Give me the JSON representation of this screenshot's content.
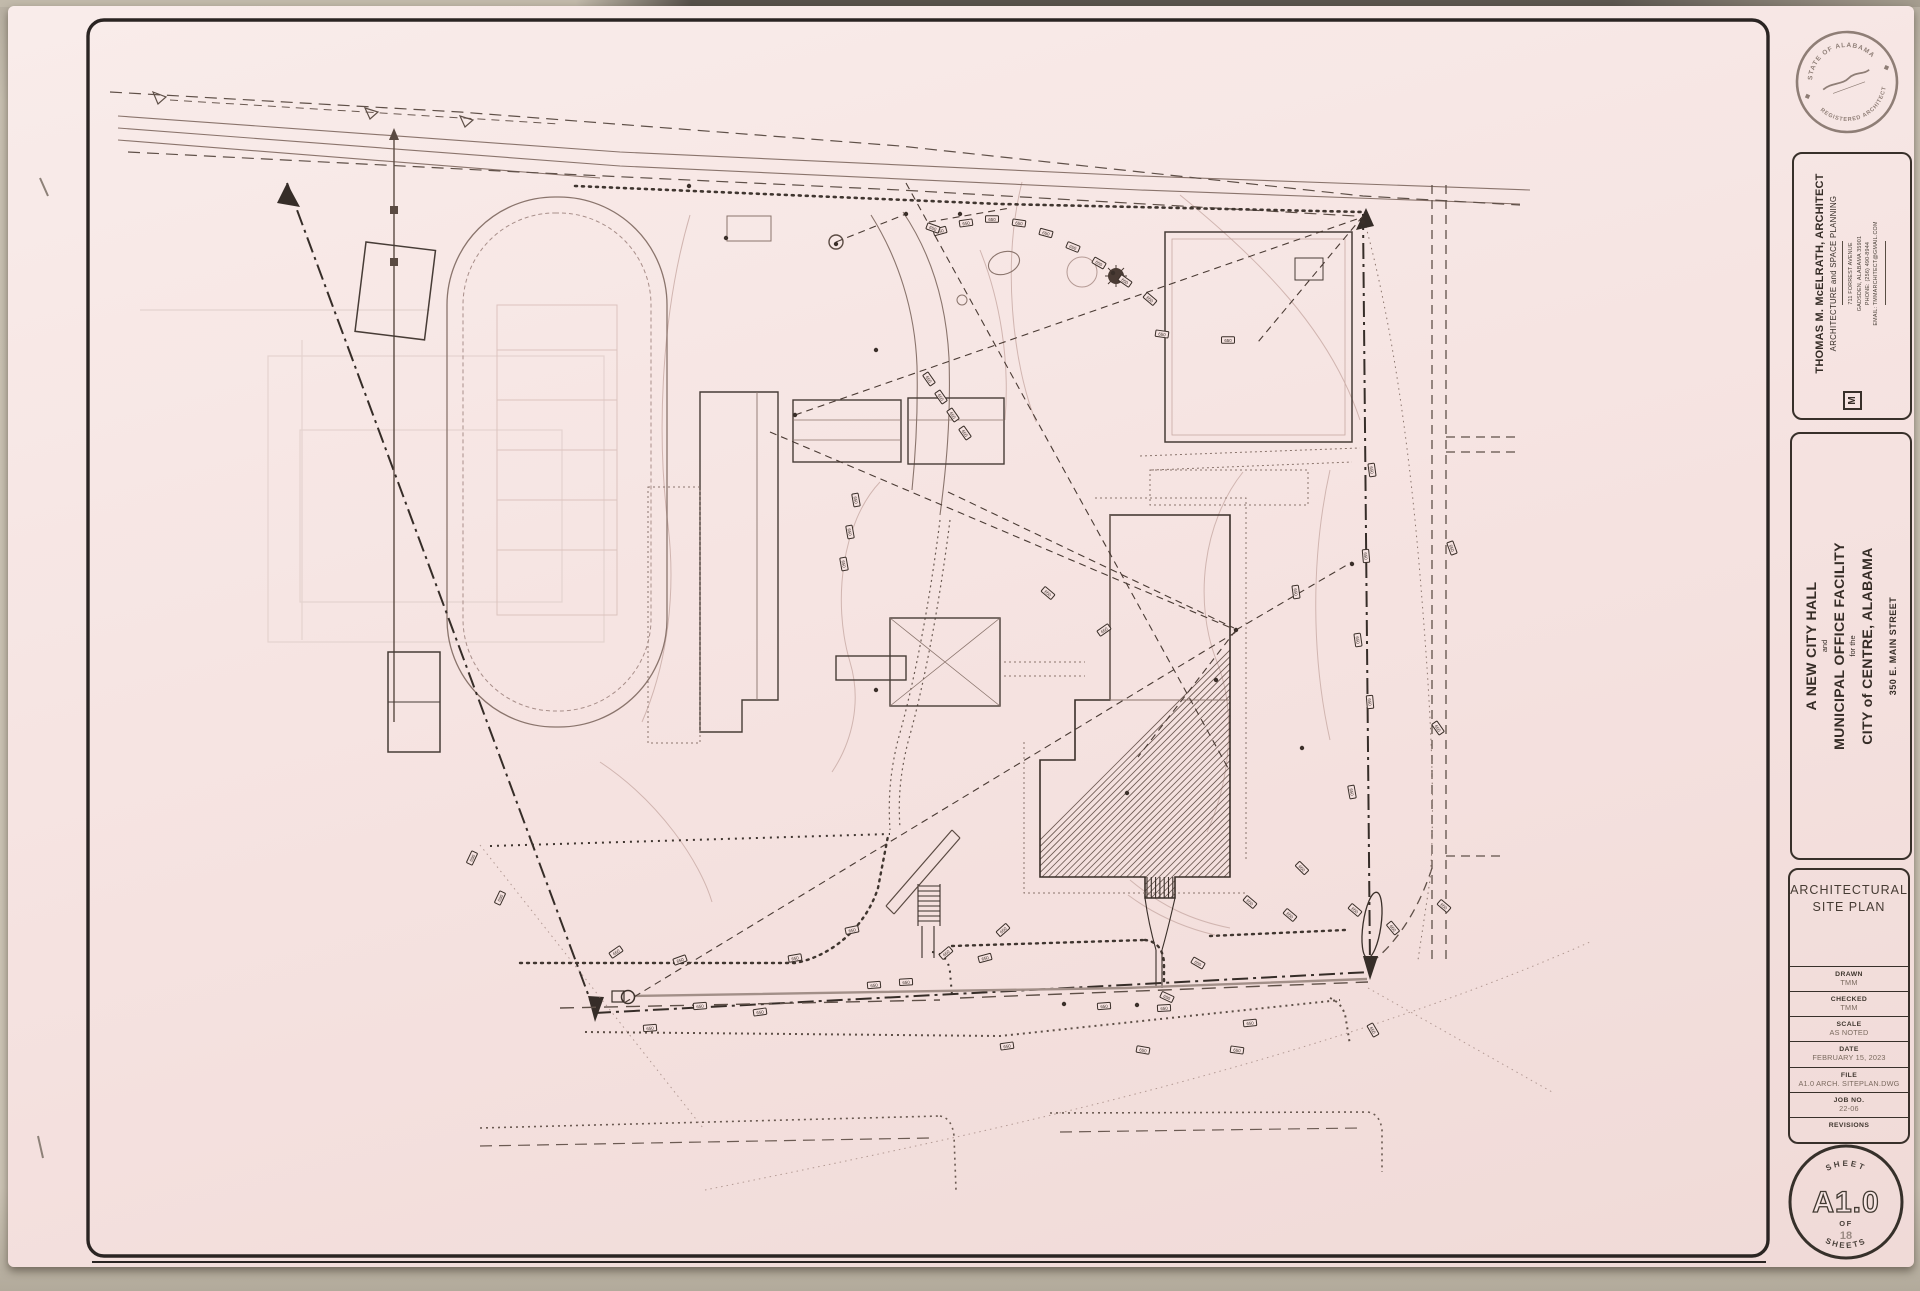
{
  "sheet": {
    "stamp": {
      "arc_top": "STATE OF ALABAMA",
      "arc_bottom": "REGISTERED ARCHITECT"
    },
    "architect": {
      "logo": "M",
      "name": "THOMAS M. McELRATH, ARCHITECT",
      "tagline": "ARCHITECTURE and SPACE PLANNING",
      "address_lines": [
        "711 FORREST AVENUE",
        "GADSDEN, ALABAMA 35901",
        "PHONE: (256) 490-8944",
        "EMAIL: TMMARCHITECT@GMAIL.COM"
      ]
    },
    "project": {
      "line1": "A NEW CITY HALL",
      "line2": "and",
      "line3": "MUNICIPAL OFFICE FACILITY",
      "line4": "for the",
      "line5": "CITY of CENTRE, ALABAMA",
      "line6": "350 E. MAIN STREET"
    },
    "title_block": {
      "sheet_title_line1": "ARCHITECTURAL",
      "sheet_title_line2": "SITE PLAN",
      "fields": [
        {
          "label": "DRAWN",
          "value": "TMM"
        },
        {
          "label": "CHECKED",
          "value": "TMM"
        },
        {
          "label": "SCALE",
          "value": "AS NOTED"
        },
        {
          "label": "DATE",
          "value": "FEBRUARY 15, 2023"
        },
        {
          "label": "FILE",
          "value": "A1.0 ARCH. SITEPLAN.DWG"
        },
        {
          "label": "JOB NO.",
          "value": "22-06"
        },
        {
          "label": "REVISIONS",
          "value": ""
        }
      ]
    },
    "sheet_circle": {
      "top": "SHEET",
      "number": "A1.0",
      "of": "OF",
      "count": "18",
      "bottom": "SHEETS"
    }
  },
  "plan": {
    "contour_label": "650",
    "tags": [
      [
        940,
        231,
        -15
      ],
      [
        966,
        223,
        -8
      ],
      [
        992,
        219,
        0
      ],
      [
        1019,
        223,
        8
      ],
      [
        1046,
        233,
        15
      ],
      [
        1073,
        247,
        22
      ],
      [
        1099,
        263,
        30
      ],
      [
        1125,
        281,
        35
      ],
      [
        1150,
        299,
        40
      ],
      [
        933,
        228,
        20
      ],
      [
        929,
        379,
        55
      ],
      [
        941,
        397,
        55
      ],
      [
        953,
        415,
        55
      ],
      [
        965,
        433,
        55
      ],
      [
        856,
        500,
        80
      ],
      [
        850,
        532,
        80
      ],
      [
        844,
        564,
        80
      ],
      [
        1048,
        593,
        40
      ],
      [
        1104,
        630,
        -35
      ],
      [
        1296,
        592,
        82
      ],
      [
        1162,
        334,
        8
      ],
      [
        1228,
        340,
        0
      ],
      [
        1372,
        470,
        82
      ],
      [
        1366,
        556,
        85
      ],
      [
        1358,
        640,
        82
      ],
      [
        1370,
        702,
        85
      ],
      [
        1352,
        792,
        80
      ],
      [
        1438,
        728,
        55
      ],
      [
        1452,
        548,
        70
      ],
      [
        1444,
        906,
        40
      ],
      [
        650,
        1028,
        -5
      ],
      [
        700,
        1006,
        -5
      ],
      [
        760,
        1012,
        -8
      ],
      [
        795,
        958,
        -10
      ],
      [
        852,
        930,
        -12
      ],
      [
        874,
        985,
        -5
      ],
      [
        906,
        982,
        -3
      ],
      [
        946,
        953,
        -40
      ],
      [
        1003,
        930,
        -42
      ],
      [
        985,
        958,
        -15
      ],
      [
        1007,
        1046,
        -8
      ],
      [
        1104,
        1006,
        -4
      ],
      [
        1164,
        1008,
        -3
      ],
      [
        1250,
        1023,
        -6
      ],
      [
        1355,
        910,
        40
      ],
      [
        1302,
        868,
        45
      ],
      [
        1250,
        902,
        40
      ],
      [
        1290,
        915,
        40
      ],
      [
        1198,
        963,
        30
      ],
      [
        1167,
        997,
        25
      ],
      [
        1143,
        1050,
        10
      ],
      [
        1237,
        1050,
        8
      ],
      [
        1373,
        1030,
        60
      ],
      [
        1393,
        928,
        50
      ],
      [
        472,
        858,
        -65
      ],
      [
        500,
        898,
        -65
      ],
      [
        616,
        952,
        -35
      ],
      [
        680,
        960,
        -20
      ]
    ],
    "dots": [
      [
        876,
        350
      ],
      [
        1113,
        273
      ],
      [
        1236,
        630
      ],
      [
        795,
        415
      ],
      [
        1064,
        1004
      ],
      [
        1137,
        1005
      ],
      [
        876,
        690
      ],
      [
        1216,
        680
      ],
      [
        1302,
        748
      ],
      [
        726,
        238
      ],
      [
        1363,
        222
      ],
      [
        1127,
        793
      ],
      [
        836,
        244
      ],
      [
        906,
        214
      ],
      [
        1352,
        564
      ],
      [
        960,
        214
      ],
      [
        689,
        186
      ]
    ],
    "leaders": [
      [
        795,
        415,
        1360,
        218
      ],
      [
        770,
        432,
        1236,
        630
      ],
      [
        1236,
        630,
        1352,
        562
      ],
      [
        1236,
        630,
        1138,
        757
      ],
      [
        624,
        1003,
        1236,
        632
      ],
      [
        906,
        183,
        1228,
        768
      ],
      [
        948,
        492,
        1234,
        628
      ],
      [
        836,
        242,
        906,
        214
      ],
      [
        1363,
        216,
        1258,
        342
      ],
      [
        929,
        222,
        1010,
        208
      ]
    ]
  }
}
